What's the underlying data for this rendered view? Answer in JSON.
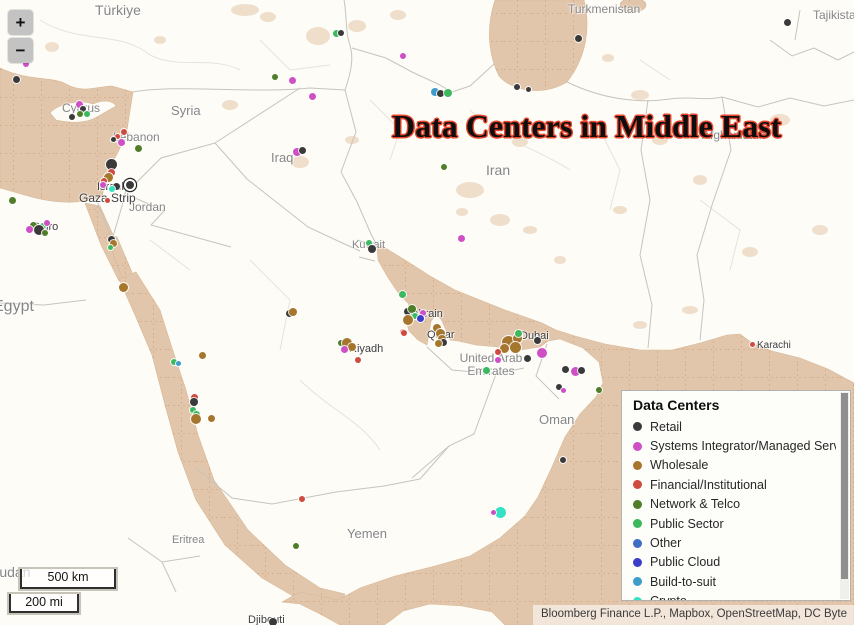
{
  "map": {
    "title": "Data Centers in Middle East",
    "attribution": "Bloomberg Finance L.P., Mapbox, OpenStreetMap, DC Byte",
    "controls": {
      "zoom_in": "+",
      "zoom_out": "−"
    },
    "scale": {
      "km": "500 km",
      "mi": "200 mi"
    },
    "colors": {
      "water": "#e2c6ab",
      "land": "#fdfcf7",
      "patch": "#ecd7c0",
      "border": "#c6c4bf",
      "admin": "#e7e3db",
      "graticule": "#c98f66"
    }
  },
  "legend": {
    "title": "Data Centers",
    "items": [
      {
        "key": "retail",
        "label": "Retail",
        "color": "#3a3a3a"
      },
      {
        "key": "si",
        "label": "Systems Integrator/Managed Services",
        "color": "#cf4fc5"
      },
      {
        "key": "wholesale",
        "label": "Wholesale",
        "color": "#a6762d"
      },
      {
        "key": "fin",
        "label": "Financial/Institutional",
        "color": "#cf4a3f"
      },
      {
        "key": "telco",
        "label": "Network & Telco",
        "color": "#4f7d28"
      },
      {
        "key": "public",
        "label": "Public Sector",
        "color": "#3cb95f"
      },
      {
        "key": "other",
        "label": "Other",
        "color": "#3f6ec6"
      },
      {
        "key": "cloud",
        "label": "Public Cloud",
        "color": "#3a3ec8"
      },
      {
        "key": "bts",
        "label": "Build-to-suit",
        "color": "#3d9cc9"
      },
      {
        "key": "crypto",
        "label": "Crypto",
        "color": "#35e2c3"
      }
    ]
  },
  "categories": {
    "retail": "#3a3a3a",
    "si": "#cf4fc5",
    "wholesale": "#a6762d",
    "fin": "#cf4a3f",
    "telco": "#4f7d28",
    "public": "#3cb95f",
    "other": "#3f6ec6",
    "cloud": "#3a3ec8",
    "bts": "#3d9cc9",
    "crypto": "#35e2c3"
  },
  "labels": [
    {
      "text": "Türkiye",
      "x": 95,
      "y": 3,
      "fs": 14
    },
    {
      "text": "Turkmenistan",
      "x": 568,
      "y": 3,
      "fs": 12
    },
    {
      "text": "Tajikistan",
      "x": 813,
      "y": 9,
      "fs": 12
    },
    {
      "text": "Cyprus",
      "x": 62,
      "y": 102,
      "fs": 12
    },
    {
      "text": "Syria",
      "x": 171,
      "y": 104,
      "fs": 13
    },
    {
      "text": "Lebanon",
      "x": 113,
      "y": 131,
      "fs": 12
    },
    {
      "text": "Iraq",
      "x": 271,
      "y": 151,
      "fs": 13
    },
    {
      "text": "Iran",
      "x": 486,
      "y": 163,
      "fs": 14
    },
    {
      "text": "Afghanistan",
      "x": 702,
      "y": 129,
      "fs": 12
    },
    {
      "text": "Jordan",
      "x": 129,
      "y": 201,
      "fs": 12
    },
    {
      "text": "Israel",
      "x": 97,
      "y": 181,
      "fs": 11,
      "dark": true
    },
    {
      "text": "Gaza Strip",
      "x": 79,
      "y": 192,
      "fs": 12,
      "dark": true
    },
    {
      "text": "Cairo",
      "x": 32,
      "y": 221,
      "fs": 11,
      "dark": true
    },
    {
      "text": "Egypt",
      "x": -7,
      "y": 298,
      "fs": 16
    },
    {
      "text": "Kuwait",
      "x": 352,
      "y": 239,
      "fs": 11
    },
    {
      "text": "Bahrain",
      "x": 405,
      "y": 308,
      "fs": 11,
      "dark": true
    },
    {
      "text": "Qatar",
      "x": 427,
      "y": 329,
      "fs": 11,
      "dark": true
    },
    {
      "text": "Dubai",
      "x": 520,
      "y": 330,
      "fs": 11,
      "dark": true
    },
    {
      "text": "United Arab\nEmirates",
      "x": 491,
      "y": 352,
      "fs": 12,
      "center": true
    },
    {
      "text": "Riyadh",
      "x": 349,
      "y": 343,
      "fs": 11,
      "dark": true
    },
    {
      "text": "Oman",
      "x": 539,
      "y": 413,
      "fs": 13
    },
    {
      "text": "Yemen",
      "x": 347,
      "y": 527,
      "fs": 13
    },
    {
      "text": "Eritrea",
      "x": 172,
      "y": 534,
      "fs": 11
    },
    {
      "text": "Djibouti",
      "x": 248,
      "y": 614,
      "fs": 11,
      "dark": true
    },
    {
      "text": "Karachi",
      "x": 757,
      "y": 340,
      "fs": 10,
      "dark": true
    },
    {
      "text": "Sudan",
      "x": -10,
      "y": 565,
      "fs": 14
    }
  ],
  "points": [
    {
      "x": 26,
      "y": 64,
      "c": "si",
      "r": 3
    },
    {
      "x": 16,
      "y": 79,
      "c": "retail",
      "r": 3.5
    },
    {
      "x": 336,
      "y": 33,
      "c": "public",
      "r": 3.5
    },
    {
      "x": 341,
      "y": 33,
      "c": "retail",
      "r": 3
    },
    {
      "x": 275,
      "y": 77,
      "c": "telco",
      "r": 3
    },
    {
      "x": 292,
      "y": 80,
      "c": "si",
      "r": 3.5
    },
    {
      "x": 312,
      "y": 96,
      "c": "si",
      "r": 3.5
    },
    {
      "x": 403,
      "y": 56,
      "c": "si",
      "r": 3
    },
    {
      "x": 435,
      "y": 92,
      "c": "bts",
      "r": 4
    },
    {
      "x": 440,
      "y": 93,
      "c": "retail",
      "r": 3.5
    },
    {
      "x": 448,
      "y": 93,
      "c": "public",
      "r": 4
    },
    {
      "x": 517,
      "y": 87,
      "c": "retail",
      "r": 3
    },
    {
      "x": 528,
      "y": 89,
      "c": "retail",
      "r": 2.5
    },
    {
      "x": 578,
      "y": 38,
      "c": "retail",
      "r": 3.5
    },
    {
      "x": 787,
      "y": 22,
      "c": "retail",
      "r": 3.5
    },
    {
      "x": 79,
      "y": 104,
      "c": "si",
      "r": 3.5
    },
    {
      "x": 83,
      "y": 109,
      "c": "retail",
      "r": 3
    },
    {
      "x": 72,
      "y": 117,
      "c": "retail",
      "r": 3
    },
    {
      "x": 80,
      "y": 114,
      "c": "telco",
      "r": 3
    },
    {
      "x": 87,
      "y": 114,
      "c": "public",
      "r": 3
    },
    {
      "x": 124,
      "y": 132,
      "c": "fin",
      "r": 3
    },
    {
      "x": 117,
      "y": 136,
      "c": "fin",
      "r": 2.5
    },
    {
      "x": 113,
      "y": 139,
      "c": "retail",
      "r": 2.5
    },
    {
      "x": 121,
      "y": 142,
      "c": "si",
      "r": 3.5
    },
    {
      "x": 138,
      "y": 148,
      "c": "telco",
      "r": 3.5
    },
    {
      "x": 111,
      "y": 164,
      "c": "retail",
      "r": 5.5
    },
    {
      "x": 111,
      "y": 172,
      "c": "fin",
      "r": 3.5
    },
    {
      "x": 108,
      "y": 177,
      "c": "wholesale",
      "r": 4.5
    },
    {
      "x": 104,
      "y": 181,
      "c": "fin",
      "r": 3
    },
    {
      "x": 103,
      "y": 185,
      "c": "si",
      "r": 3
    },
    {
      "x": 116,
      "y": 186,
      "c": "retail",
      "r": 3.5
    },
    {
      "x": 112,
      "y": 189,
      "c": "crypto",
      "r": 3
    },
    {
      "x": 128,
      "y": 183,
      "c": "retail",
      "r": 4,
      "ring": true
    },
    {
      "x": 107,
      "y": 200,
      "c": "fin",
      "r": 2.5
    },
    {
      "x": 297,
      "y": 152,
      "c": "si",
      "r": 4
    },
    {
      "x": 302,
      "y": 150,
      "c": "retail",
      "r": 3.5
    },
    {
      "x": 444,
      "y": 167,
      "c": "telco",
      "r": 3
    },
    {
      "x": 461,
      "y": 238,
      "c": "si",
      "r": 3.5
    },
    {
      "x": 369,
      "y": 243,
      "c": "public",
      "r": 3
    },
    {
      "x": 372,
      "y": 249,
      "c": "retail",
      "r": 4
    },
    {
      "x": 12,
      "y": 200,
      "c": "telco",
      "r": 3.5
    },
    {
      "x": 33,
      "y": 225,
      "c": "telco",
      "r": 3.5
    },
    {
      "x": 43,
      "y": 226,
      "c": "public",
      "r": 3
    },
    {
      "x": 29,
      "y": 229,
      "c": "si",
      "r": 3.5
    },
    {
      "x": 47,
      "y": 223,
      "c": "si",
      "r": 3
    },
    {
      "x": 39,
      "y": 230,
      "c": "retail",
      "r": 5
    },
    {
      "x": 45,
      "y": 233,
      "c": "telco",
      "r": 3
    },
    {
      "x": 111,
      "y": 239,
      "c": "retail",
      "r": 3.5
    },
    {
      "x": 113,
      "y": 243,
      "c": "wholesale",
      "r": 3.5
    },
    {
      "x": 110,
      "y": 247,
      "c": "public",
      "r": 2.5
    },
    {
      "x": 123,
      "y": 287,
      "c": "wholesale",
      "r": 4.5
    },
    {
      "x": 202,
      "y": 355,
      "c": "wholesale",
      "r": 3.5
    },
    {
      "x": 174,
      "y": 362,
      "c": "public",
      "r": 3
    },
    {
      "x": 178,
      "y": 363,
      "c": "bts",
      "r": 2.5
    },
    {
      "x": 194,
      "y": 397,
      "c": "fin",
      "r": 3.5
    },
    {
      "x": 194,
      "y": 402,
      "c": "retail",
      "r": 4
    },
    {
      "x": 193,
      "y": 410,
      "c": "public",
      "r": 3
    },
    {
      "x": 196,
      "y": 414,
      "c": "public",
      "r": 3.5
    },
    {
      "x": 196,
      "y": 419,
      "c": "wholesale",
      "r": 5
    },
    {
      "x": 211,
      "y": 418,
      "c": "wholesale",
      "r": 3.5
    },
    {
      "x": 289,
      "y": 313,
      "c": "retail",
      "r": 3.5
    },
    {
      "x": 293,
      "y": 312,
      "c": "wholesale",
      "r": 4
    },
    {
      "x": 341,
      "y": 343,
      "c": "telco",
      "r": 3
    },
    {
      "x": 347,
      "y": 343,
      "c": "wholesale",
      "r": 5
    },
    {
      "x": 352,
      "y": 347,
      "c": "wholesale",
      "r": 4
    },
    {
      "x": 344,
      "y": 349,
      "c": "si",
      "r": 3.5
    },
    {
      "x": 358,
      "y": 360,
      "c": "fin",
      "r": 3
    },
    {
      "x": 403,
      "y": 332,
      "c": "fin",
      "r": 3
    },
    {
      "x": 402,
      "y": 294,
      "c": "public",
      "r": 3.5
    },
    {
      "x": 407,
      "y": 311,
      "c": "retail",
      "r": 3.5
    },
    {
      "x": 412,
      "y": 309,
      "c": "telco",
      "r": 4
    },
    {
      "x": 415,
      "y": 316,
      "c": "public",
      "r": 3
    },
    {
      "x": 423,
      "y": 313,
      "c": "si",
      "r": 3
    },
    {
      "x": 420,
      "y": 318,
      "c": "cloud",
      "r": 3.5
    },
    {
      "x": 408,
      "y": 320,
      "c": "wholesale",
      "r": 5
    },
    {
      "x": 404,
      "y": 333,
      "c": "fin",
      "r": 3
    },
    {
      "x": 437,
      "y": 328,
      "c": "wholesale",
      "r": 4
    },
    {
      "x": 440,
      "y": 333,
      "c": "wholesale",
      "r": 4.5
    },
    {
      "x": 442,
      "y": 339,
      "c": "wholesale",
      "r": 4
    },
    {
      "x": 443,
      "y": 342,
      "c": "retail",
      "r": 3.5
    },
    {
      "x": 438,
      "y": 343,
      "c": "wholesale",
      "r": 3.5
    },
    {
      "x": 508,
      "y": 342,
      "c": "wholesale",
      "r": 6.5
    },
    {
      "x": 517,
      "y": 338,
      "c": "wholesale",
      "r": 4.5
    },
    {
      "x": 515,
      "y": 347,
      "c": "wholesale",
      "r": 5.5
    },
    {
      "x": 504,
      "y": 348,
      "c": "wholesale",
      "r": 4.5
    },
    {
      "x": 518,
      "y": 333,
      "c": "public",
      "r": 3.5
    },
    {
      "x": 537,
      "y": 340,
      "c": "retail",
      "r": 3.5
    },
    {
      "x": 542,
      "y": 353,
      "c": "si",
      "r": 5
    },
    {
      "x": 498,
      "y": 352,
      "c": "fin",
      "r": 3
    },
    {
      "x": 498,
      "y": 360,
      "c": "si",
      "r": 3
    },
    {
      "x": 527,
      "y": 358,
      "c": "retail",
      "r": 3.5
    },
    {
      "x": 486,
      "y": 370,
      "c": "public",
      "r": 3.5
    },
    {
      "x": 565,
      "y": 369,
      "c": "retail",
      "r": 3.5
    },
    {
      "x": 575,
      "y": 371,
      "c": "si",
      "r": 4.5
    },
    {
      "x": 581,
      "y": 370,
      "c": "retail",
      "r": 3.5
    },
    {
      "x": 559,
      "y": 387,
      "c": "retail",
      "r": 3
    },
    {
      "x": 563,
      "y": 390,
      "c": "si",
      "r": 2.5
    },
    {
      "x": 599,
      "y": 390,
      "c": "telco",
      "r": 3
    },
    {
      "x": 563,
      "y": 460,
      "c": "retail",
      "r": 3
    },
    {
      "x": 500,
      "y": 512,
      "c": "crypto",
      "r": 5.5
    },
    {
      "x": 493,
      "y": 512,
      "c": "si",
      "r": 2.5
    },
    {
      "x": 302,
      "y": 499,
      "c": "fin",
      "r": 3
    },
    {
      "x": 296,
      "y": 546,
      "c": "telco",
      "r": 3
    },
    {
      "x": 273,
      "y": 622,
      "c": "retail",
      "r": 4
    },
    {
      "x": 752,
      "y": 344,
      "c": "fin",
      "r": 2.5
    }
  ]
}
